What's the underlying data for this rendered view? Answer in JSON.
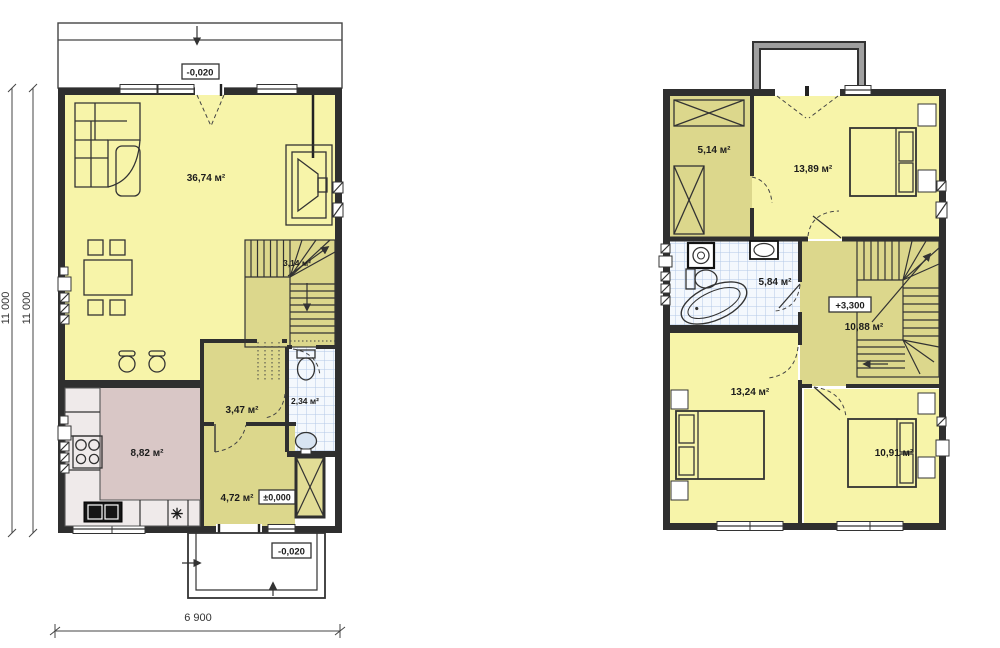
{
  "floor1": {
    "rooms": {
      "living": "36,74 м²",
      "stairwell": "3,14 м²",
      "storage": "3,47 м²",
      "wc": "2,34 м²",
      "kitchen": "8,82 м²",
      "hallway": "4,72 м²"
    },
    "levels": {
      "terrace": "-0,020",
      "entry": "±0,000",
      "porch": "-0,020"
    },
    "dimensions": {
      "width": "6 900",
      "height_outer": "11 000",
      "height_inner": "11 000"
    },
    "icons": {
      "freezer": "✳"
    }
  },
  "floor2": {
    "rooms": {
      "wardrobe": "5,14 м²",
      "bedroom_large": "13,89 м²",
      "bathroom": "5,84 м²",
      "hall": "10,88 м²",
      "bedroom_left": "13,24 м²",
      "bedroom_right": "10,91 м²"
    },
    "levels": {
      "landing": "+3,300"
    }
  },
  "colors": {
    "room_yellow": "#f7f4a9",
    "room_olive": "#dcd78c",
    "closet_olive": "#e2dd96",
    "kitchen_pink": "#d9c7c6",
    "counter": "#efeaea",
    "tile_fill": "#f4f8fd",
    "tile_grid": "#b3c9e6",
    "wall": "#2f2f2f",
    "balcony_gray": "#a0a0a0"
  }
}
